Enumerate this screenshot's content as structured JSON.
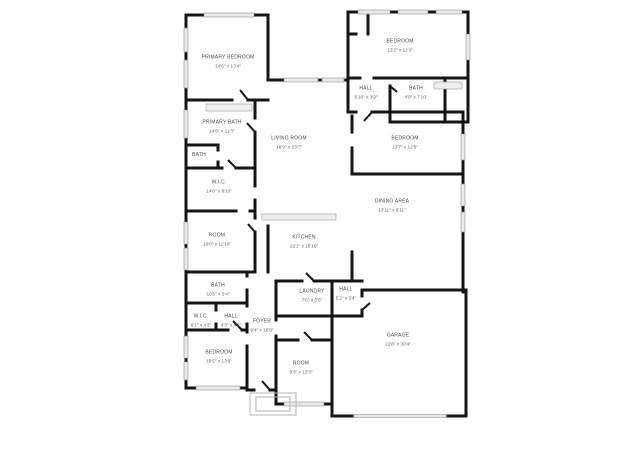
{
  "palette": {
    "background": "#ffffff",
    "wall": "#151515",
    "window_fill": "#e9e9e9",
    "window_edge": "#8f8f8f",
    "fixture_fill": "#efefef",
    "label_text": "#4a4a4a",
    "dims_text": "#606060",
    "porch_line": "#b5b5b5"
  },
  "floor_plan": {
    "rooms": [
      {
        "id": "primary-bedroom",
        "name": "PRIMARY BEDROOM",
        "dims": "14'6\" x 13'4\""
      },
      {
        "id": "bedroom-top-right",
        "name": "BEDROOM",
        "dims": "13'2\" x 11'3\""
      },
      {
        "id": "hall-top-right",
        "name": "HALL",
        "dims": "6'10\" x 3'9\""
      },
      {
        "id": "bath-top-right",
        "name": "BATH",
        "dims": "4'9\" x 7'10\""
      },
      {
        "id": "bedroom-right",
        "name": "BEDROOM",
        "dims": "13'7\" x 12'5\""
      },
      {
        "id": "living-room",
        "name": "LIVING ROOM",
        "dims": "18'9\" x 23'7\""
      },
      {
        "id": "primary-bath",
        "name": "PRIMARY BATH",
        "dims": "14'6\" x 11'3\""
      },
      {
        "id": "bath-left-small",
        "name": "BATH",
        "dims": ""
      },
      {
        "id": "wic-left",
        "name": "W.I.C.",
        "dims": "14'6\" x 8'10\""
      },
      {
        "id": "room-left",
        "name": "ROOM",
        "dims": "10'8\" x 11'10\""
      },
      {
        "id": "dining-area",
        "name": "DINING AREA",
        "dims": "13'11\" x 9'11\""
      },
      {
        "id": "kitchen",
        "name": "KITCHEN",
        "dims": "22'1\" x 15'10\""
      },
      {
        "id": "bath-lower-left",
        "name": "BATH",
        "dims": "10'5\" x 5'4\""
      },
      {
        "id": "wic-bottom",
        "name": "W.I.C.",
        "dims": "6'1\" x 4'2\""
      },
      {
        "id": "hall-bottom-left",
        "name": "HALL",
        "dims": "4'3\" x 4'2\""
      },
      {
        "id": "foyer",
        "name": "FOYER",
        "dims": "9'4\" x 18'9\""
      },
      {
        "id": "bedroom-bottom-left",
        "name": "BEDROOM",
        "dims": "16'5\" x 13'9\""
      },
      {
        "id": "laundry",
        "name": "LAUNDRY",
        "dims": "7'6\" x 5'6\""
      },
      {
        "id": "hall-bottom",
        "name": "HALL",
        "dims": "5'2\" x 5'4\""
      },
      {
        "id": "room-bottom",
        "name": "ROOM",
        "dims": "9'3\" x 12'3\""
      },
      {
        "id": "garage",
        "name": "GARAGE",
        "dims": "22'8\" x 30'4\""
      }
    ]
  }
}
